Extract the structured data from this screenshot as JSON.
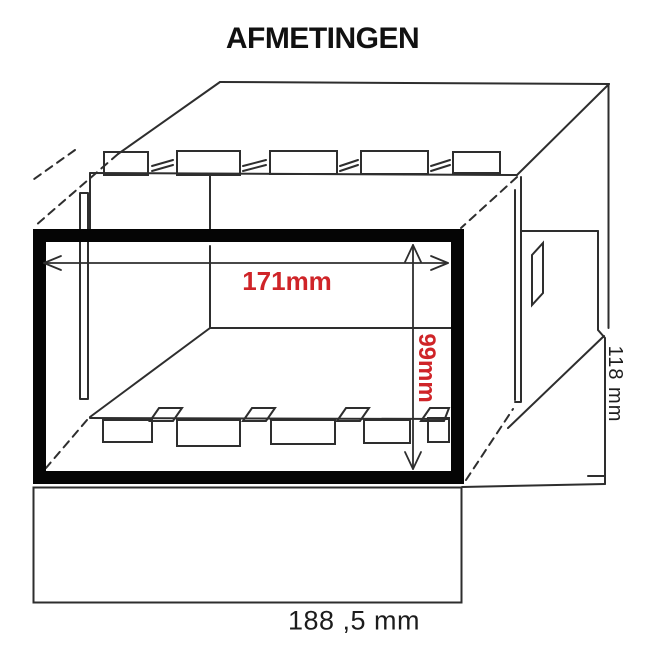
{
  "title": "AFMETINGEN",
  "drawing": {
    "description": "Isometric line drawing of a panel-mount enclosure with front bezel, mounting tabs and dimension lines",
    "labels": {
      "inner_width": "171mm",
      "inner_height": "99mm",
      "depth": "118 mm",
      "outer_width": "188 ,5 mm"
    },
    "colors": {
      "dimension_red": "#cf2428",
      "line": "#2e2e2e",
      "bezel": "#050505",
      "background": "#ffffff"
    }
  }
}
